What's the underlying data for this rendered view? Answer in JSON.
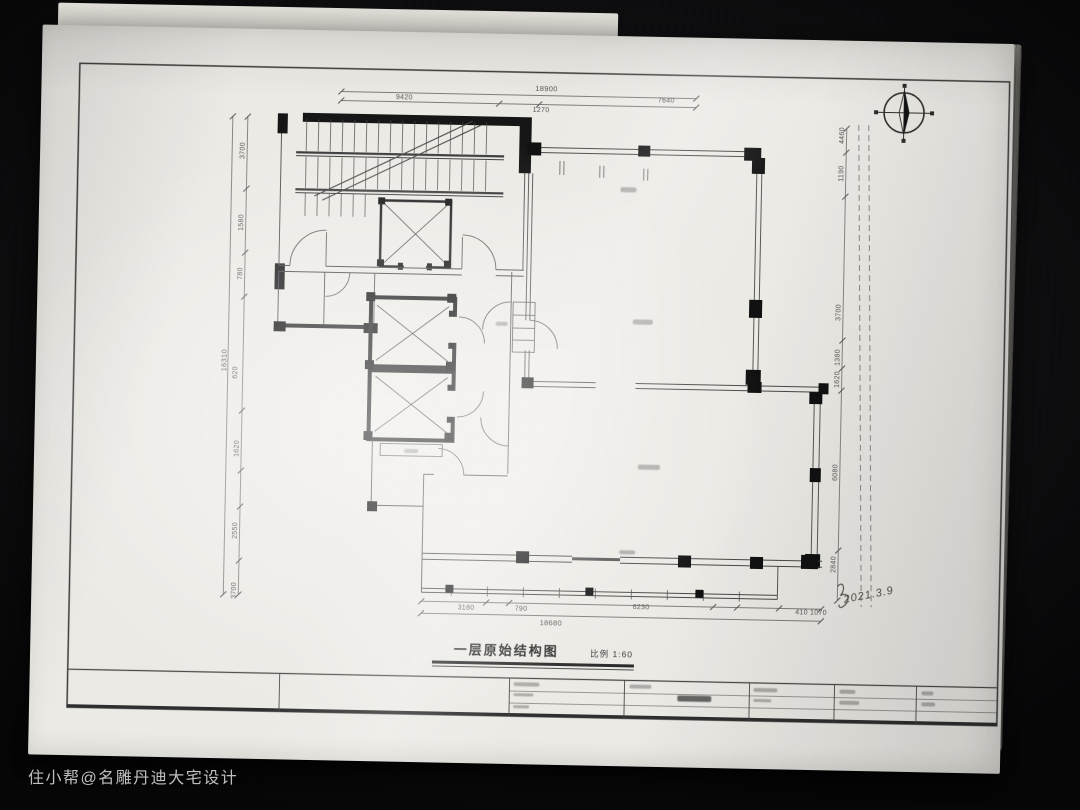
{
  "colors": {
    "desk_background": "#0b0b0d",
    "paper": "#eceae5",
    "ink": "#3c3c3c",
    "wall_fill": "#161616"
  },
  "icons": {
    "north_arrow": "compass-crosshair-with-needle"
  },
  "watermark": {
    "text": "住小帮@名雕丹迪大宅设计"
  },
  "sheet": {
    "title": "一层原始结构图",
    "scale_label": "比例 1:60",
    "handwritten_date": "2021.3.9"
  },
  "dims": {
    "top": {
      "overall": "18900",
      "segments": [
        "9420",
        "1270",
        "7640"
      ]
    },
    "bottom": {
      "overall": "18680",
      "segments": [
        "3180",
        "790",
        "6230",
        "410 1070"
      ]
    },
    "left": {
      "overall": "16310",
      "segments": [
        "3700",
        "1580",
        "780",
        "620",
        "1620",
        "2550",
        "3700"
      ]
    },
    "right": {
      "segments": [
        "4460",
        "1190",
        "3700",
        "1380",
        "1620",
        "6080",
        "2840"
      ]
    }
  }
}
